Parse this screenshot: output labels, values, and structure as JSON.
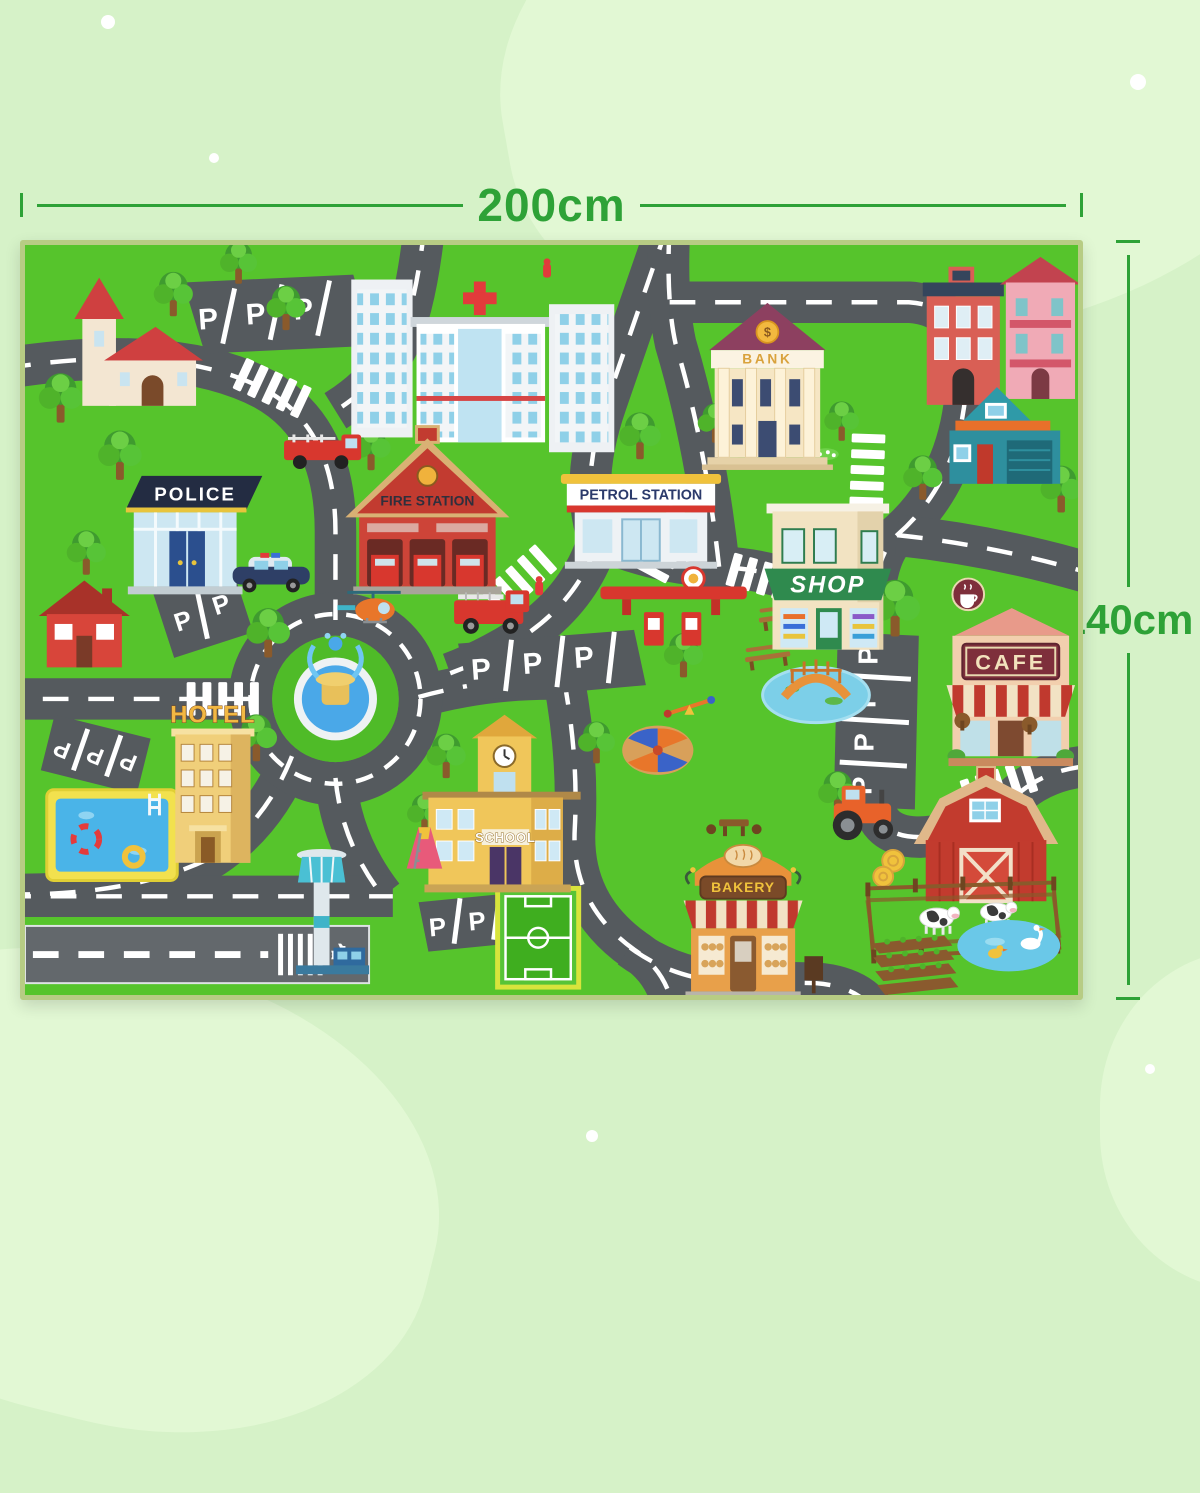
{
  "dimensions": {
    "width": "200cm",
    "height": "140cm"
  },
  "colors": {
    "dimension_text": "#2ea237",
    "grass": "#56c42c",
    "road": "#555a5e",
    "page_background": "#d6f2c8"
  },
  "mat": {
    "buildings": {
      "police": "POLICE",
      "fire_station": "FIRE STATION",
      "petrol_station": "PETROL STATION",
      "shop": "SHOP",
      "bank": "BANK",
      "bank_coin": "$",
      "cafe": "CAFE",
      "hotel": "HOTEL",
      "school": "SCHOOL",
      "bakery": "BAKERY"
    },
    "parking_letter": "P",
    "airplane_glyph": "✈"
  }
}
